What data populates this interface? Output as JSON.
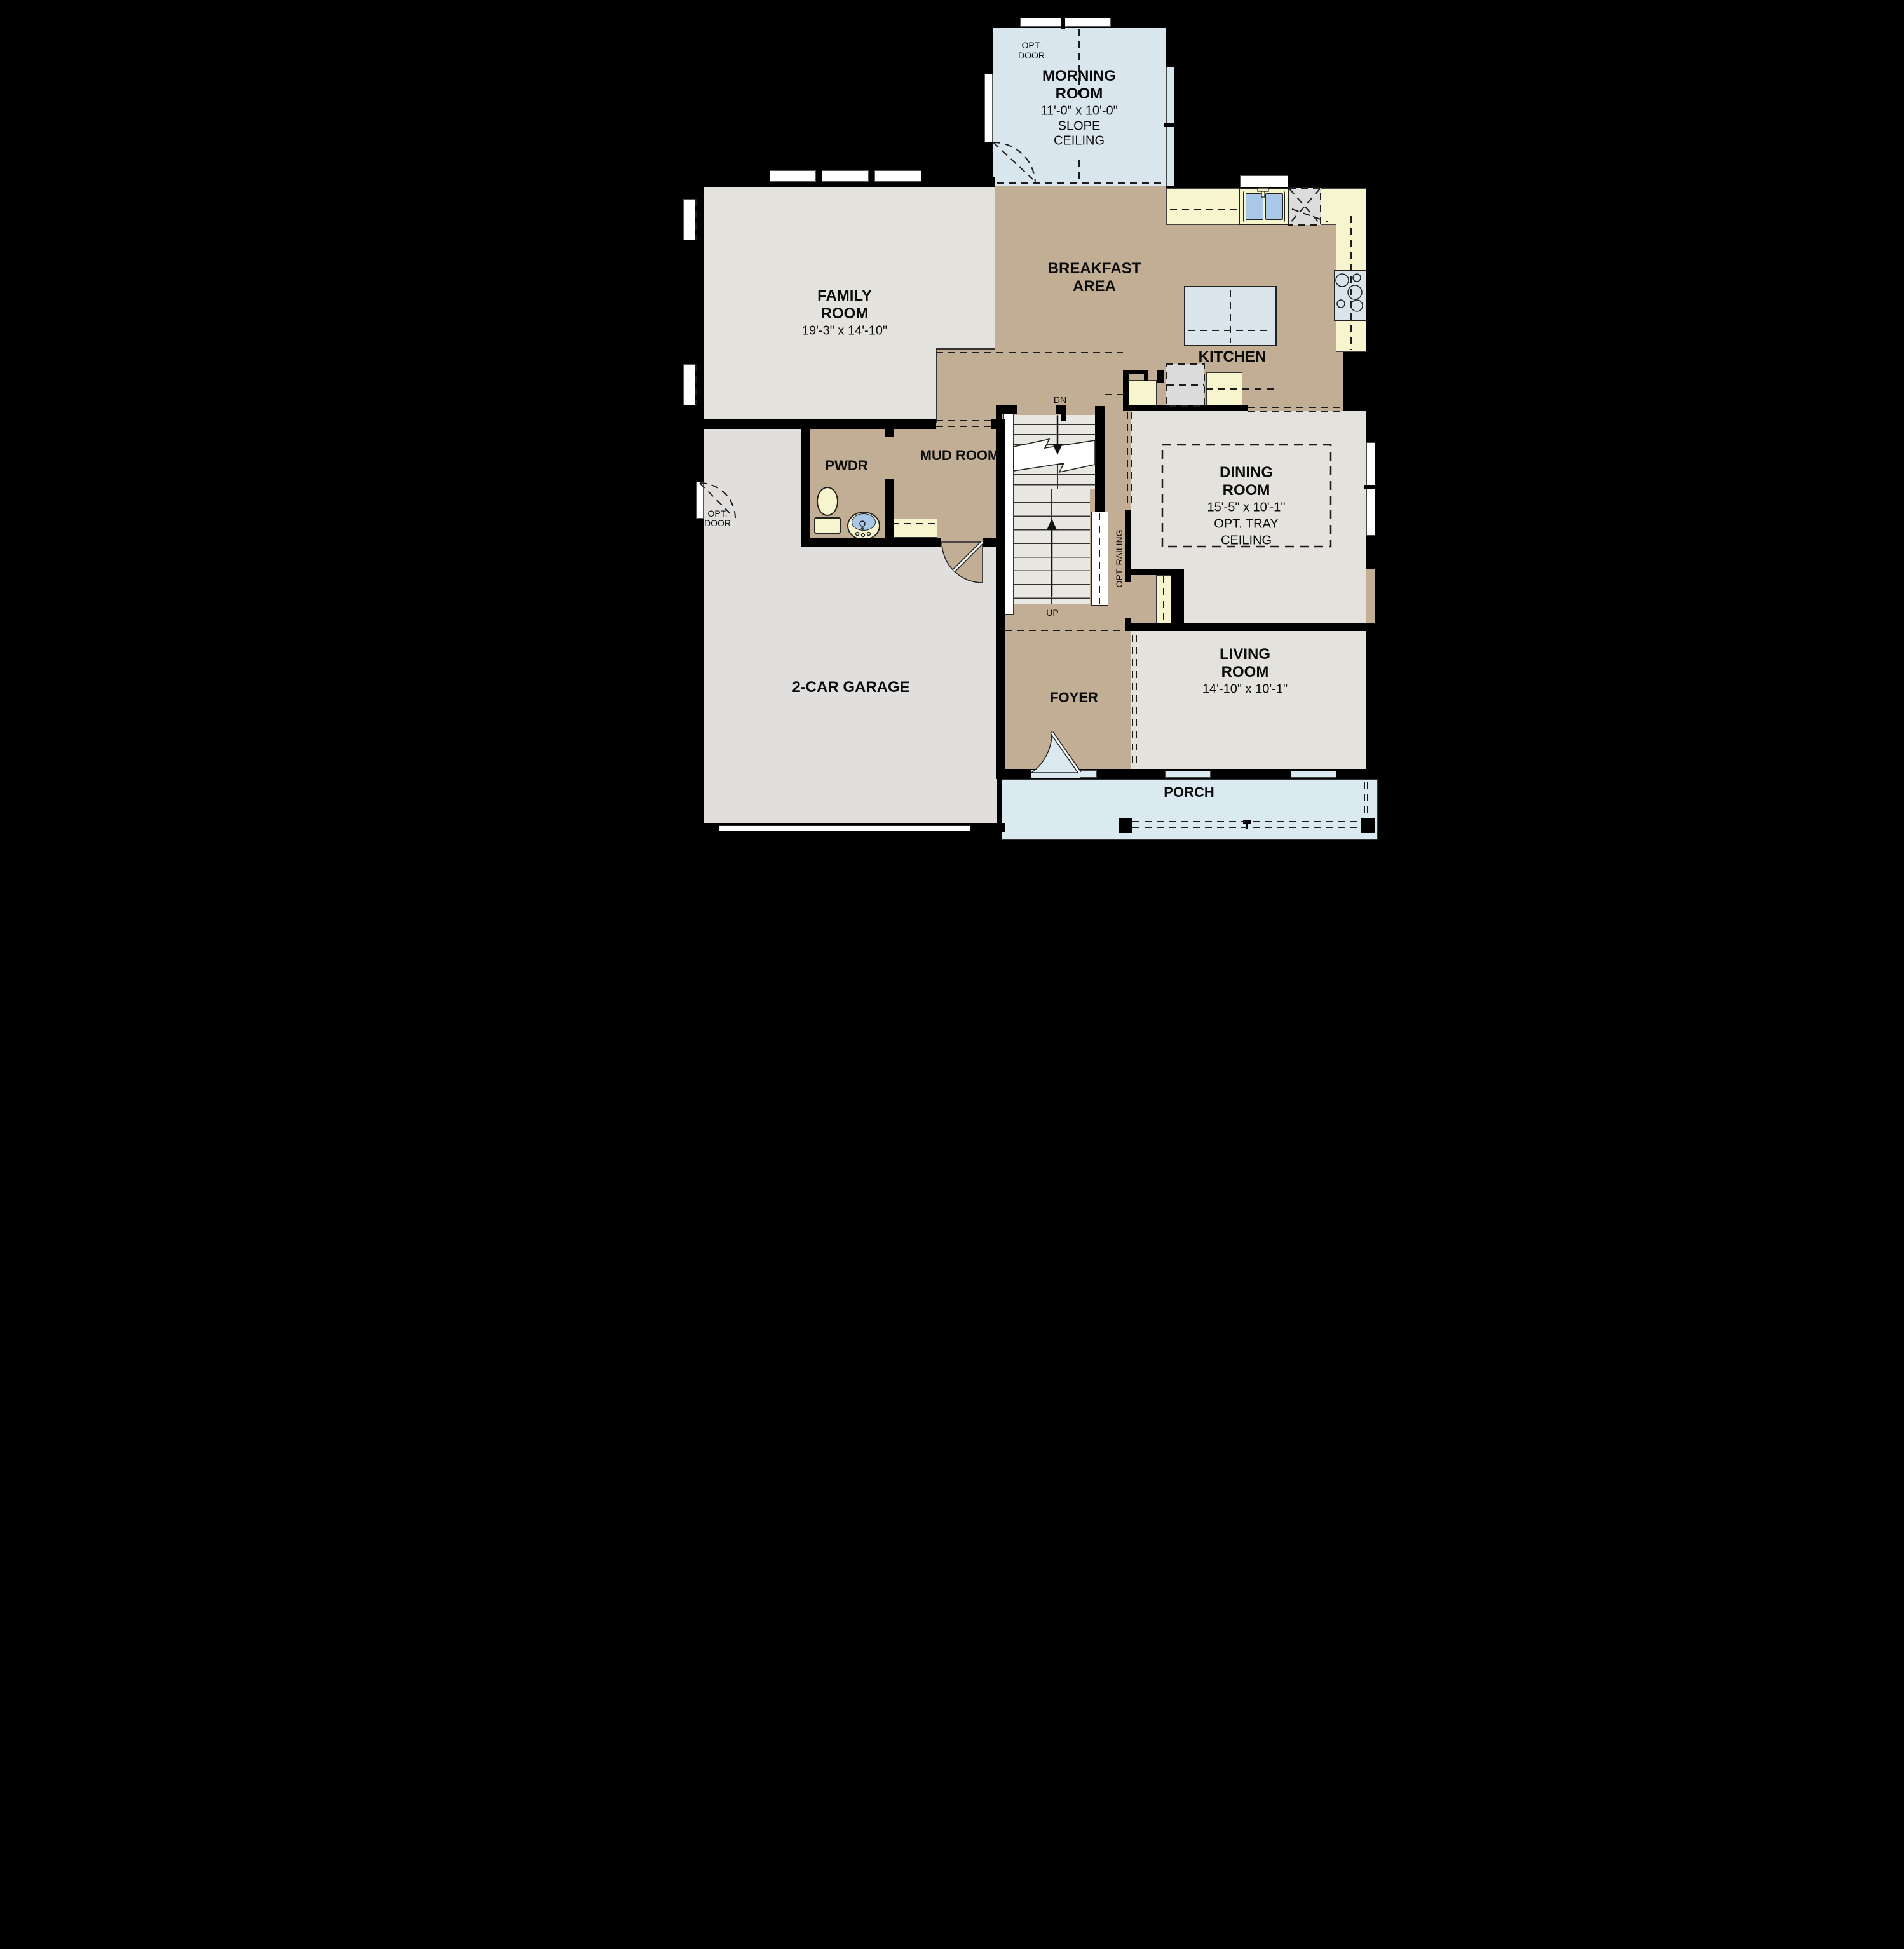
{
  "title": "First Floor Plan",
  "colors": {
    "wall": "#000000",
    "floor_tan": "#c1ae95",
    "floor_gray": "#e4e2dd",
    "floor_garage": "#e0dfde",
    "floor_morning": "#dae6ed",
    "floor_porch": "#dbe9f1",
    "counter_yellow": "#f7f5ce",
    "fixture_blue": "#d9e5ea",
    "basin_blue": "#a9c7e7",
    "appliance_gray": "#dbdbdb",
    "tread": "#e9e7e2"
  },
  "rooms": {
    "morning": {
      "name1": "MORNING",
      "name2": "ROOM",
      "dim": "11'-0\" x 10'-0\"",
      "note1": "SLOPE",
      "note2": "CEILING"
    },
    "family": {
      "name1": "FAMILY",
      "name2": "ROOM",
      "dim": "19'-3\" x 14'-10\""
    },
    "breakfast": {
      "name1": "BREAKFAST",
      "name2": "AREA"
    },
    "kitchen": {
      "name": "KITCHEN"
    },
    "dining": {
      "name1": "DINING",
      "name2": "ROOM",
      "dim": "15'-5\" x 10'-1\"",
      "note1": "OPT. TRAY",
      "note2": "CEILING"
    },
    "living": {
      "name1": "LIVING",
      "name2": "ROOM",
      "dim": "14'-10\" x 10'-1\""
    },
    "pwdr": {
      "name": "PWDR"
    },
    "mud": {
      "name": "MUD ROOM"
    },
    "garage": {
      "name": "2-CAR GARAGE"
    },
    "foyer": {
      "name": "FOYER"
    },
    "porch": {
      "name": "PORCH"
    }
  },
  "annotations": {
    "dn": "DN",
    "up": "UP",
    "opt_railing": "OPT. RAILING",
    "opt_door1": "OPT.",
    "opt_door2": "DOOR"
  }
}
